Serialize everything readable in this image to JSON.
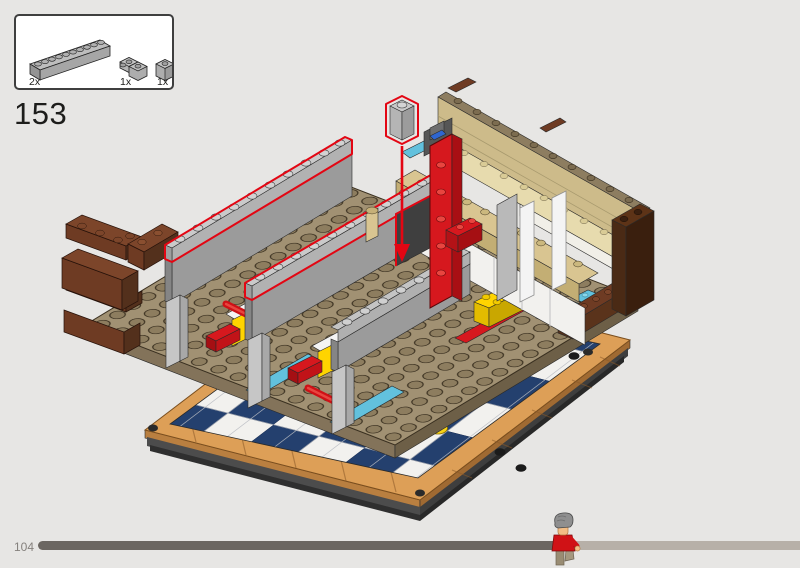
{
  "step": {
    "number": "153"
  },
  "parts_callout": {
    "items": [
      {
        "count": "2x",
        "part": "brick-1x10-light-gray"
      },
      {
        "count": "1x",
        "part": "brick-2x2-corner-light-gray"
      },
      {
        "count": "1x",
        "part": "brick-1x1-light-gray"
      }
    ]
  },
  "footer": {
    "page_number": "104",
    "progress_fraction": 0.678,
    "marker": "minifigure-progress-marker"
  },
  "colors": {
    "background": "#e7e6e4",
    "highlight_red": "#e30613",
    "checker_blue": "#24406e",
    "checker_white": "#f2f1ee",
    "border_tan": "#dd9f57",
    "plate_tan": "#a19173",
    "brick_brown": "#6e3b23",
    "lego_red": "#d6181e",
    "lego_yellow": "#ffd400",
    "azure": "#62c1dd",
    "counter_tan": "#d9c591",
    "progress_done": "#6b6661",
    "progress_remaining": "#b7b0a8"
  }
}
